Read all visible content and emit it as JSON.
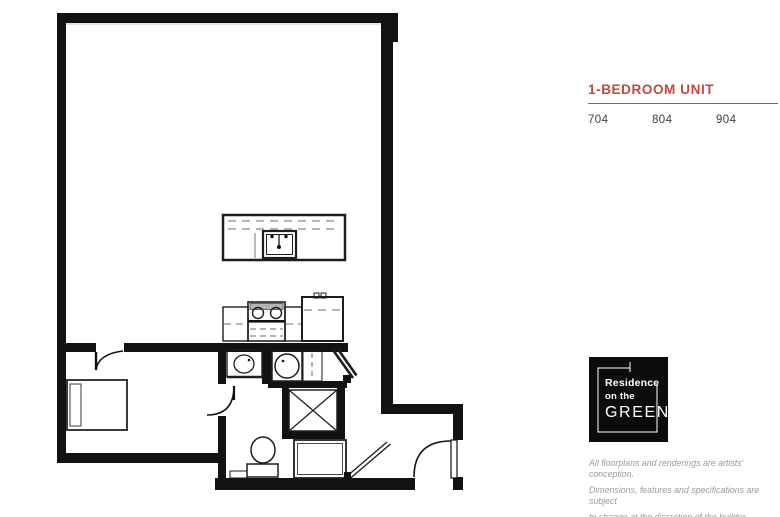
{
  "accent_color": "#c2493d",
  "panel": {
    "title": "1-BEDROOM UNIT",
    "units": [
      "704",
      "804",
      "904"
    ],
    "logo": {
      "line1": "Residence",
      "line2": "on the",
      "line3": "GREEN"
    },
    "disclaimer": [
      "All floorplans and renderings are artists' conception.",
      "Dimensions, features and specifications are subject",
      "to change at the discretion of the builder."
    ]
  },
  "floorplan": {
    "description": "1-bedroom unit floor plan drawing",
    "fixtures": [
      "kitchen-island-with-sink",
      "range-with-burners",
      "refrigerator",
      "kitchen-counter",
      "washer",
      "closet-bifold",
      "shaft-x-box",
      "vanity-sink",
      "toilet",
      "shower-with-glass-door",
      "bed",
      "bedroom-door",
      "bathroom-door",
      "entry-door"
    ]
  }
}
